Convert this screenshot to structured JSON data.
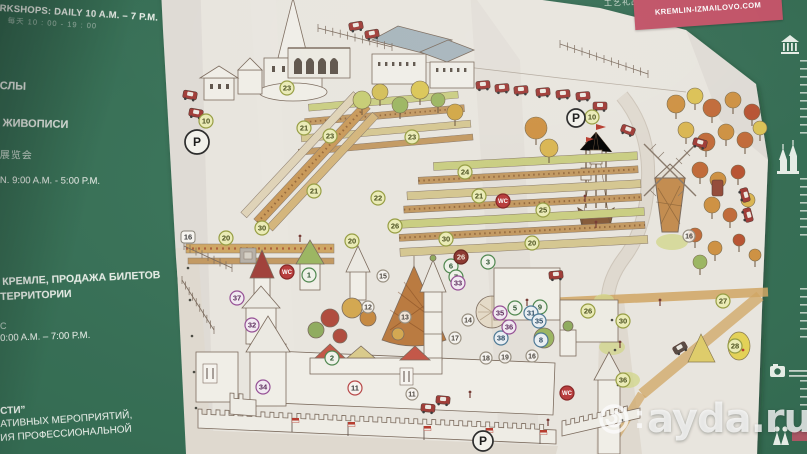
{
  "board": {
    "left_panel": {
      "line1": "RKSHOPS: DAILY 10 A.M. – 7 P.M.",
      "line2": "每天 10 : 00 - 19 : 00",
      "line3": "СЛЫ",
      "line4": "К ЖИВОПИСИ",
      "line5": "展览会",
      "line6": "N. 9:00 A.M. - 5:00 P.M.",
      "line7": "КРЕМЛЕ, ПРОДАЖА БИЛЕТОВ",
      "line8": "ТЕРРИТОРИИ",
      "line9": "С",
      "line10": "0:00 A.M. – 7:00 P.M.",
      "line11": "СТИ”",
      "line12": "АТИВНЫХ МЕРОПРИЯТИЙ,",
      "line13": "ИЯ ПРОФЕССИОНАЛЬНОЙ"
    },
    "banner": {
      "top_fragment": "ОВО",
      "url": "KREMLIN-IZMAILOVO.COM",
      "chinese_fragment": "工艺礼品"
    },
    "watermark": "ayda.ru"
  },
  "map": {
    "markers": [
      {
        "t": "10",
        "x": 206,
        "y": 121,
        "s": "yellow"
      },
      {
        "t": "10",
        "x": 592,
        "y": 117,
        "s": "yellow"
      },
      {
        "t": "20",
        "x": 226,
        "y": 238,
        "s": "yellow"
      },
      {
        "t": "20",
        "x": 352,
        "y": 241,
        "s": "yellow"
      },
      {
        "t": "20",
        "x": 532,
        "y": 243,
        "s": "yellow"
      },
      {
        "t": "21",
        "x": 304,
        "y": 128,
        "s": "yellow"
      },
      {
        "t": "21",
        "x": 314,
        "y": 191,
        "s": "yellow"
      },
      {
        "t": "21",
        "x": 479,
        "y": 196,
        "s": "yellow"
      },
      {
        "t": "22",
        "x": 378,
        "y": 198,
        "s": "yellow"
      },
      {
        "t": "23",
        "x": 287,
        "y": 88,
        "s": "yellow"
      },
      {
        "t": "23",
        "x": 330,
        "y": 136,
        "s": "yellow"
      },
      {
        "t": "23",
        "x": 412,
        "y": 137,
        "s": "yellow"
      },
      {
        "t": "24",
        "x": 465,
        "y": 172,
        "s": "yellow"
      },
      {
        "t": "25",
        "x": 543,
        "y": 210,
        "s": "yellow"
      },
      {
        "t": "26",
        "x": 395,
        "y": 226,
        "s": "yellow"
      },
      {
        "t": "26",
        "x": 588,
        "y": 311,
        "s": "yellow"
      },
      {
        "t": "27",
        "x": 723,
        "y": 301,
        "s": "yellow"
      },
      {
        "t": "28",
        "x": 735,
        "y": 346,
        "s": "yellow"
      },
      {
        "t": "30",
        "x": 262,
        "y": 228,
        "s": "yellow"
      },
      {
        "t": "30",
        "x": 446,
        "y": 239,
        "s": "yellow"
      },
      {
        "t": "30",
        "x": 623,
        "y": 321,
        "s": "yellow"
      },
      {
        "t": "36",
        "x": 623,
        "y": 380,
        "s": "yellow"
      },
      {
        "t": "1",
        "x": 309,
        "y": 275,
        "s": "green"
      },
      {
        "t": "2",
        "x": 332,
        "y": 358,
        "s": "green"
      },
      {
        "t": "3",
        "x": 488,
        "y": 262,
        "s": "green"
      },
      {
        "t": "5",
        "x": 515,
        "y": 308,
        "s": "green"
      },
      {
        "t": "6",
        "x": 451,
        "y": 266,
        "s": "green"
      },
      {
        "t": "7",
        "x": 456,
        "y": 277,
        "s": "green"
      },
      {
        "t": "9",
        "x": 540,
        "y": 307,
        "s": "green"
      },
      {
        "t": "8",
        "x": 541,
        "y": 340,
        "s": "blue"
      },
      {
        "t": "31",
        "x": 531,
        "y": 313,
        "s": "blue"
      },
      {
        "t": "35",
        "x": 539,
        "y": 321,
        "s": "blue"
      },
      {
        "t": "38",
        "x": 501,
        "y": 338,
        "s": "blue"
      },
      {
        "t": "32",
        "x": 252,
        "y": 325,
        "s": "purple"
      },
      {
        "t": "33",
        "x": 458,
        "y": 283,
        "s": "purple"
      },
      {
        "t": "34",
        "x": 263,
        "y": 387,
        "s": "purple"
      },
      {
        "t": "35",
        "x": 500,
        "y": 313,
        "s": "purple"
      },
      {
        "t": "36",
        "x": 509,
        "y": 327,
        "s": "purple"
      },
      {
        "t": "37",
        "x": 237,
        "y": 298,
        "s": "purple"
      },
      {
        "t": "11",
        "x": 355,
        "y": 388,
        "s": "redring"
      },
      {
        "t": "11",
        "x": 412,
        "y": 394,
        "s": "plain"
      },
      {
        "t": "12",
        "x": 368,
        "y": 307,
        "s": "plain"
      },
      {
        "t": "13",
        "x": 405,
        "y": 317,
        "s": "plain"
      },
      {
        "t": "14",
        "x": 468,
        "y": 320,
        "s": "plain"
      },
      {
        "t": "15",
        "x": 383,
        "y": 276,
        "s": "plain"
      },
      {
        "t": "16",
        "x": 532,
        "y": 356,
        "s": "plain"
      },
      {
        "t": "16",
        "x": 689,
        "y": 236,
        "s": "plain"
      },
      {
        "t": "17",
        "x": 455,
        "y": 338,
        "s": "plain"
      },
      {
        "t": "18",
        "x": 486,
        "y": 358,
        "s": "plain"
      },
      {
        "t": "19",
        "x": 505,
        "y": 357,
        "s": "plain"
      },
      {
        "t": "26",
        "x": 461,
        "y": 257,
        "s": "dark"
      },
      {
        "t": "16",
        "x": 188,
        "y": 237,
        "s": "square"
      },
      {
        "t": "WC",
        "x": 287,
        "y": 272,
        "s": "wc"
      },
      {
        "t": "WC",
        "x": 503,
        "y": 201,
        "s": "wc"
      },
      {
        "t": "WC",
        "x": 567,
        "y": 393,
        "s": "wc"
      },
      {
        "t": "P",
        "x": 197,
        "y": 142,
        "s": "parking",
        "r": 12
      },
      {
        "t": "P",
        "x": 576,
        "y": 118,
        "s": "parking",
        "r": 9
      },
      {
        "t": "P",
        "x": 483,
        "y": 441,
        "s": "parking",
        "r": 10
      }
    ]
  }
}
